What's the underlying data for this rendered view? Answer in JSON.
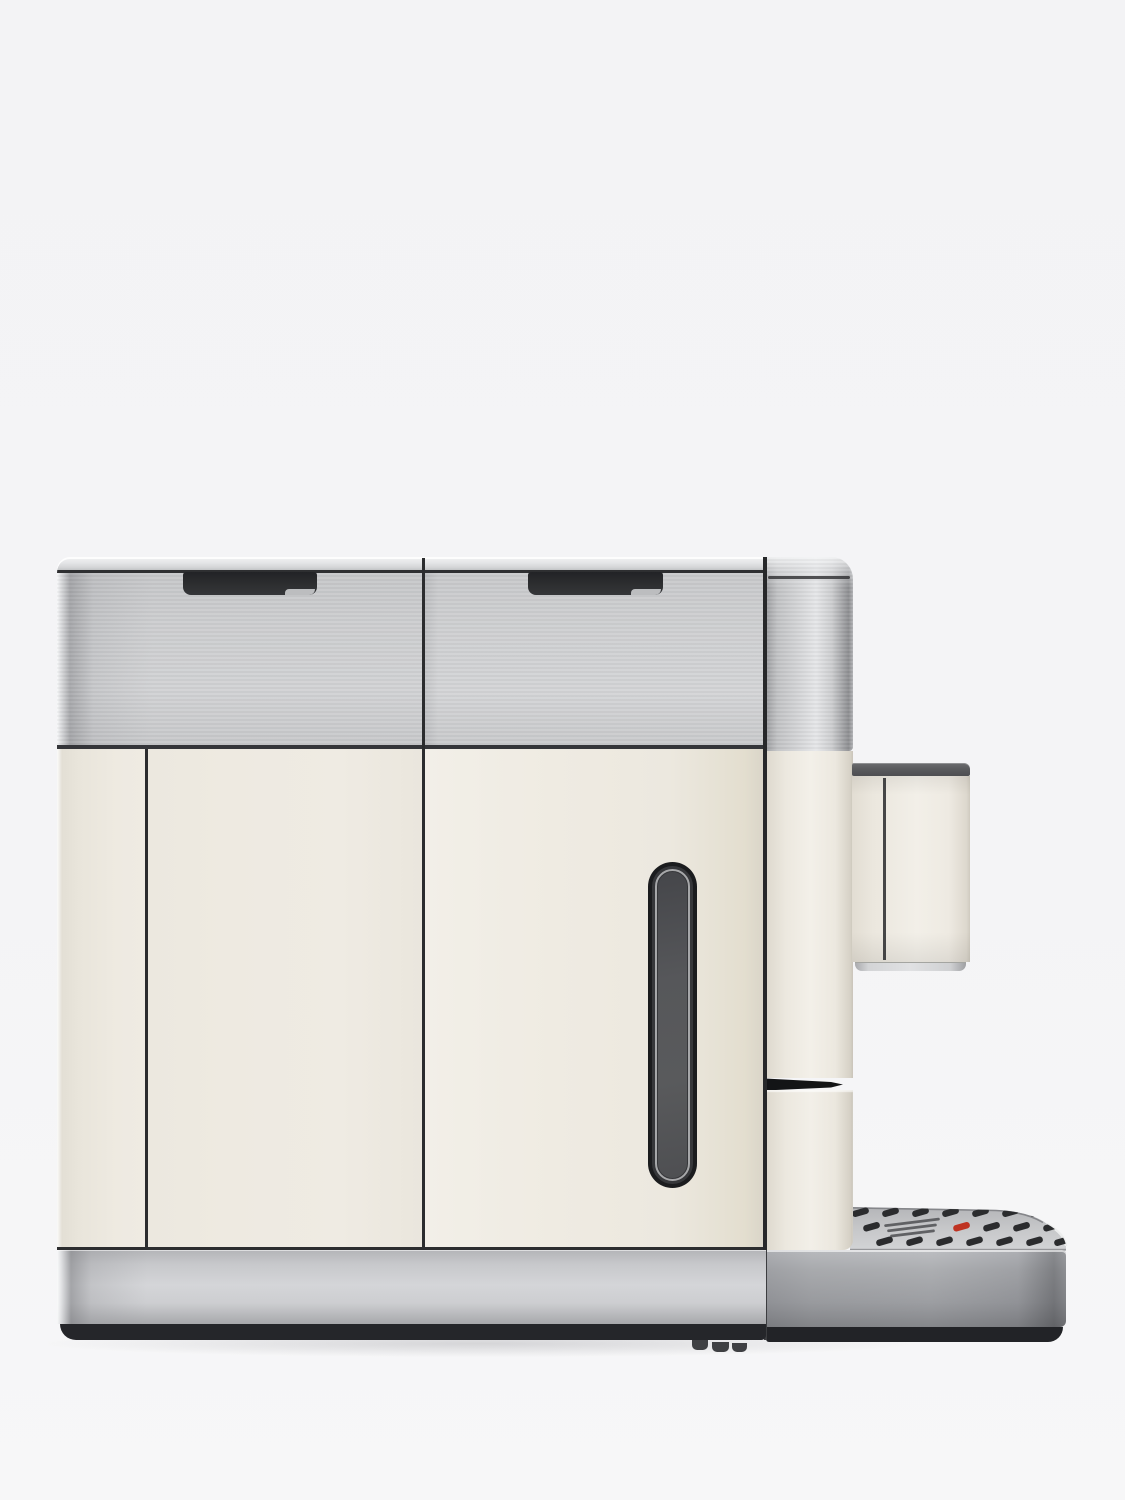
{
  "scene": {
    "description": "Side-view product photograph of an automatic bean-to-cup coffee machine with a cream body, brushed stainless steel top band and base, side water-level window, coffee spout and perforated drip tray",
    "background_color": "#f4f4f6"
  },
  "machine": {
    "body_cream_color": "#eeeae1",
    "stainless_color": "#cdced0",
    "seam_color": "#2b2c2e",
    "top_lids": {
      "left_lid_handle_slot_color": "#2d2e30",
      "right_lid_handle_slot_color": "#2d2e30"
    },
    "water_level_window": {
      "frame_color": "#1b1c1e",
      "ring_color": "#a6a7a9",
      "glass_color": "#525356"
    },
    "spout": {
      "cap_color": "#595a5d",
      "body_color": "#efebe2",
      "trim_color": "#d0d1d3"
    },
    "base": {
      "band_color": "#c9cacd",
      "plinth_color": "#25262a"
    },
    "drip_tray": {
      "grate_color": "#c6c7c9",
      "slot_color": "#2b2c2e",
      "float_indicator_color": "#bf3322",
      "front_color": "#c0c1c4"
    }
  }
}
